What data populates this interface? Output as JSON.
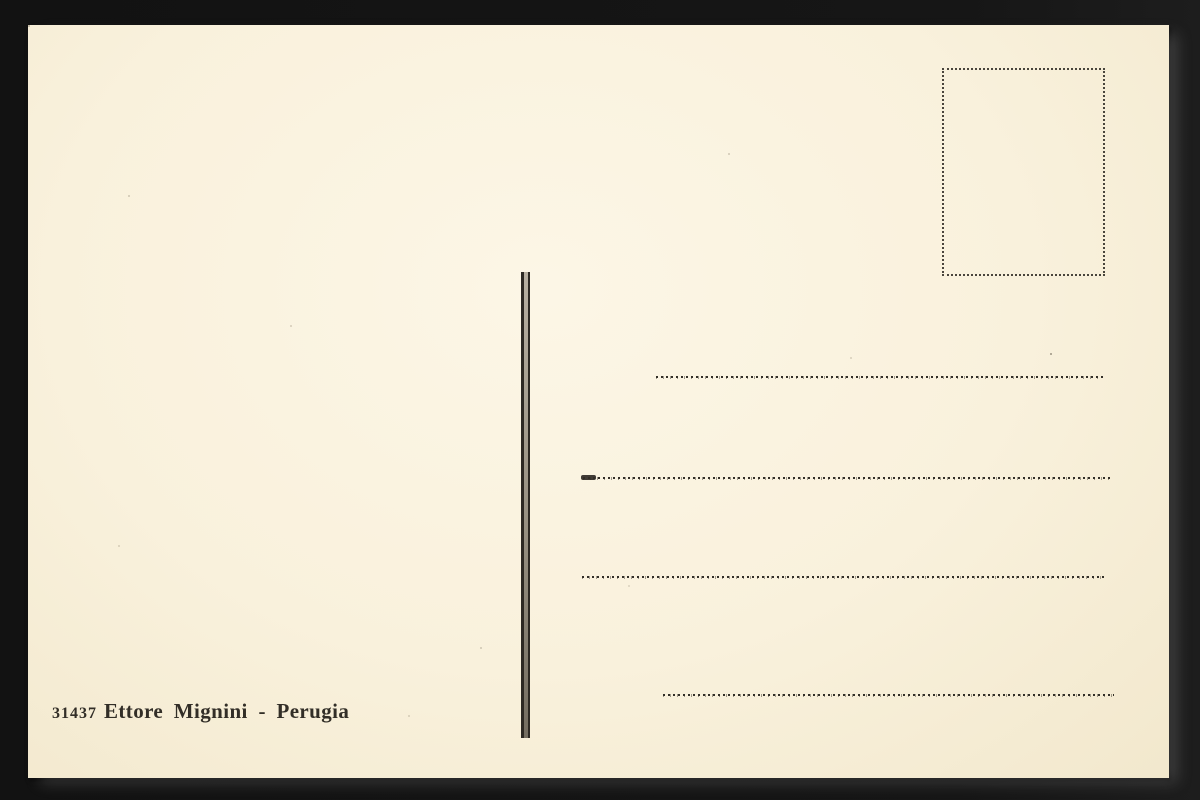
{
  "postcard": {
    "publisher_number": "31437",
    "publisher_text": "Ettore Mignini - Perugia",
    "publisher_line_full": "31437 Ettore Mignini - Perugia",
    "address_line_count": 4,
    "colors": {
      "paper": "#f9f1dc",
      "background": "#151515",
      "ink": "#322e27"
    }
  }
}
